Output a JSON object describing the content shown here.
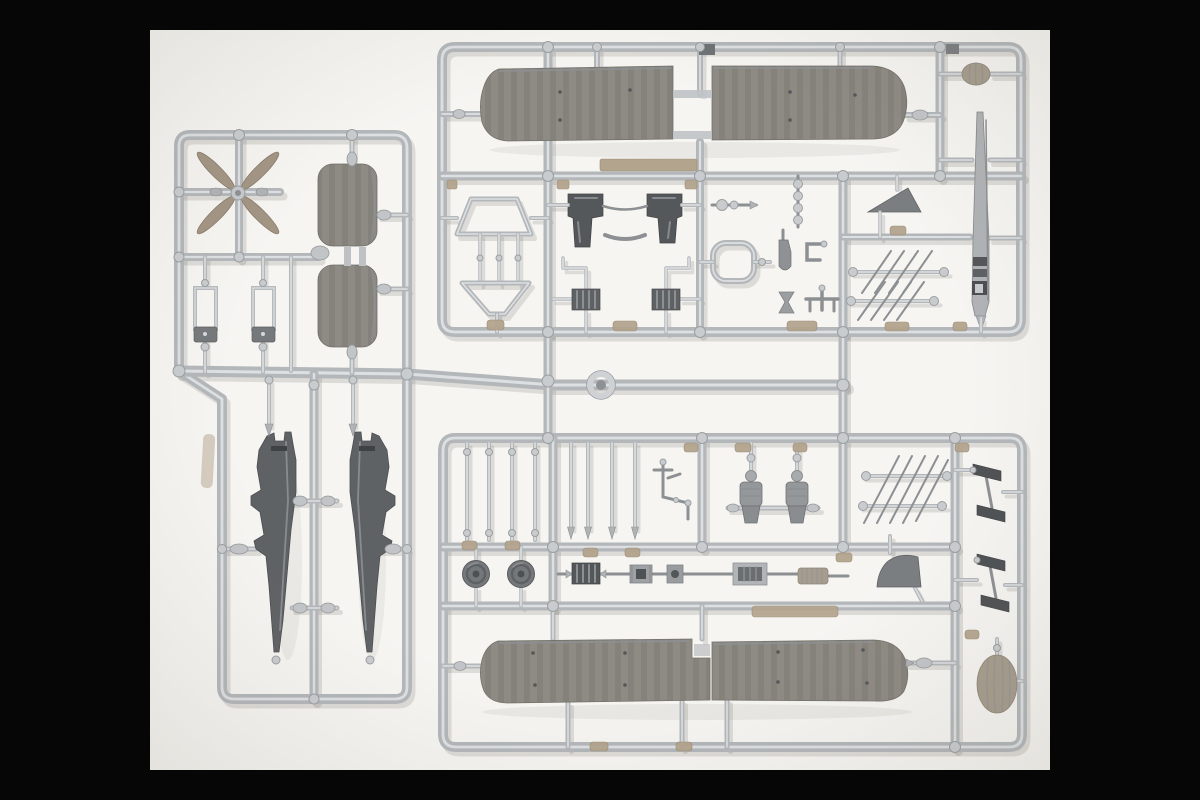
{
  "scene": {
    "type": "photograph",
    "subject": "plastic model kit sprues",
    "description": "Top-down photograph of light gray injection-molded polystyrene sprues of a biplane model aircraft kit: ribbed upper and lower wing halves, two tapered fuselage halves, a propeller, stabilizer slabs, strut ladders, wheels, engine fittings and small parts, all attached to runner frames on a white backdrop with black letterbox bars.",
    "visible_text": ""
  },
  "palette": {
    "bar": "#060606",
    "bg": "#f6f5f2",
    "runner": "#b3b7ba",
    "runner-hi": "#dde0e3",
    "runner-dk": "#94989c",
    "knob": "#c9ccce",
    "part": "#8e8a84",
    "part-rib": "#6f6b64",
    "part-hi": "#c3c0ba",
    "part-dark": "#5f6265",
    "part-darker": "#4c4e51",
    "detail-dark": "#54575a",
    "tan": "#b3a48d",
    "tan2": "#a79d8e",
    "blade-tan": "#a39584",
    "shadow": "rgba(70,64,54,0.14)"
  },
  "sprues": {
    "left": {
      "label": "left sprue",
      "parts": [
        "six-blade propeller",
        "ribbed stabilizer slabs (2)",
        "open rectangular frames with dark bases (2)",
        "tapered fuselage halves (2)",
        "washer ring on feed runner"
      ]
    },
    "upper_right": {
      "label": "upper main sprue",
      "parts": [
        "upper wing halves with rib detail (2)",
        "egg-shaped cowl",
        "tall tapered mast with hatch detail",
        "cabane strut trapezoids (2)",
        "engine bearer boots (2)",
        "finned cylinder banks (2)",
        "axle shaft",
        "rounded cockpit coaming ring",
        "linked exhaust stack",
        "bottle fitting",
        "bracket hook",
        "hourglass fitting",
        "rudder bar",
        "triangular tail fin",
        "interplane strut ladders (2)",
        "tan walkway strip"
      ]
    },
    "lower_right": {
      "label": "lower main sprue",
      "parts": [
        "spindle struts (4)",
        "pointed struts (4)",
        "gun linkage assembly",
        "segmented crew/engine blocks (2)",
        "interplane strut ladder",
        "stepped exhaust parts (2)",
        "wheels (2)",
        "finned engine block",
        "spool fittings (2)",
        "radiator frame",
        "corrugated drum",
        "quarter-circle fin",
        "flat tan strip",
        "lower wing halves with rib detail (2)",
        "egg-shaped float tip"
      ]
    }
  }
}
